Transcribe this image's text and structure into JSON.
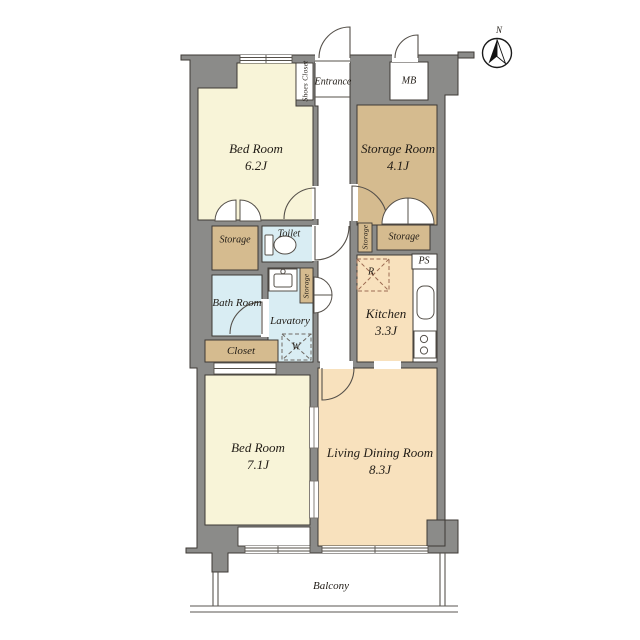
{
  "compass": {
    "north": "N"
  },
  "rooms": {
    "bed62": {
      "label": "Bed Room",
      "size": "6.2J"
    },
    "storage_room": {
      "label": "Storage Room",
      "size": "4.1J"
    },
    "bed71": {
      "label": "Bed Room",
      "size": "7.1J"
    },
    "living": {
      "label": "Living Dining Room",
      "size": "8.3J"
    },
    "kitchen": {
      "label": "Kitchen",
      "size": "3.3J"
    },
    "bath": {
      "label": "Bath Room"
    },
    "lavatory": {
      "label": "Lavatory"
    },
    "toilet": {
      "label": "Toilet"
    },
    "closet": {
      "label": "Closet"
    },
    "entrance": {
      "label": "Entrance"
    },
    "shoes_closet": {
      "label": "Shoes Closet"
    },
    "balcony": {
      "label": "Balcony"
    }
  },
  "fixtures": {
    "meter_box": "MB",
    "pipe_space": "PS",
    "storage": "Storage",
    "washer": "W",
    "refrigerator": "R"
  },
  "colors": {
    "wall": "#8b8b89",
    "outline": "#3e3a35",
    "cream": "#f8f4d8",
    "tan": "#d5bb8f",
    "blue": "#d9edf3",
    "peach": "#f8e1bd",
    "white": "#ffffff",
    "line": "#55504a",
    "appliance_dash": "#9c6b52"
  }
}
